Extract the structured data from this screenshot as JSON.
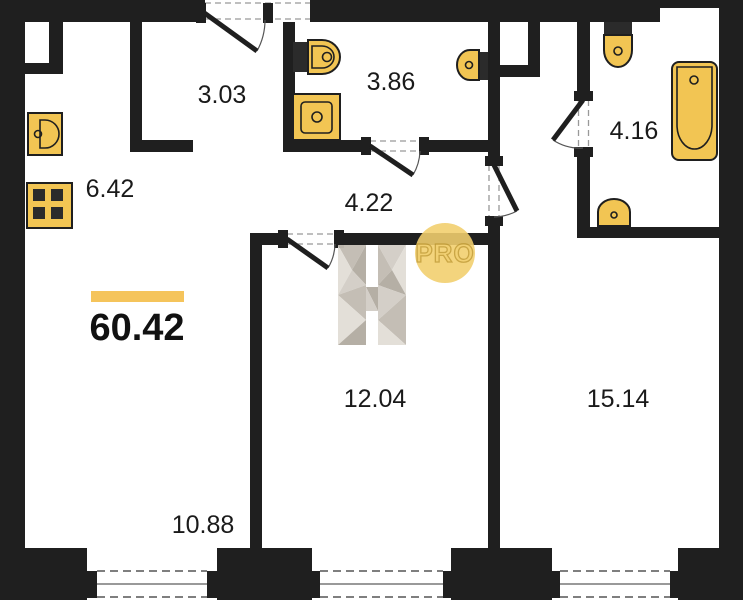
{
  "floor_plan": {
    "total": {
      "area": "60.42"
    },
    "rooms": {
      "hallway": {
        "area": "3.03"
      },
      "wc": {
        "area": "3.86"
      },
      "bathroom": {
        "area": "4.16"
      },
      "kitchen": {
        "area": "6.42"
      },
      "corridor": {
        "area": "4.22"
      },
      "bedroom": {
        "area": "12.04"
      },
      "master_bedroom": {
        "area": "15.14"
      },
      "living_room": {
        "area": "10.88"
      }
    },
    "watermark": {
      "logo_letter": "H",
      "badge": "PRO"
    },
    "fixtures": [
      "kitchen-sink",
      "stove",
      "toilet",
      "shower-tray",
      "bidet",
      "bathtub",
      "washbasin"
    ],
    "colors": {
      "wall": "#1F1F1F",
      "fixture_fill": "#F2C553",
      "accent_bar": "#F5C45B",
      "pro_badge_fill": "#F1CF6E",
      "pro_text_stroke": "#C8A33E",
      "watermark_grays": [
        "#E2DED7",
        "#D3CEC6",
        "#C2BCB2",
        "#B3ACA2"
      ]
    }
  }
}
